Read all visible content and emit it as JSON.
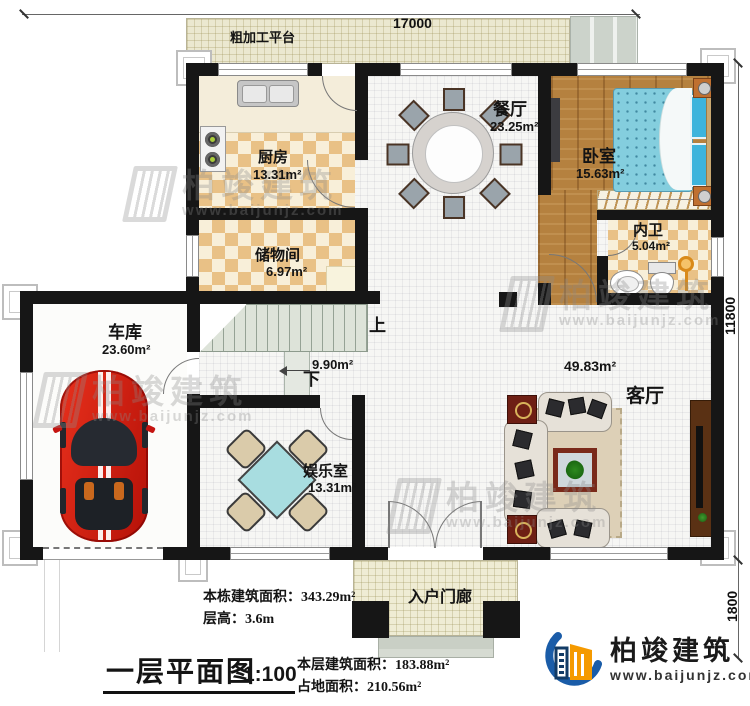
{
  "title": {
    "name": "一层平面图",
    "scale": "1:100"
  },
  "dimensions": {
    "top": "17000",
    "right_upper": "11800",
    "right_lower": "1800"
  },
  "rooms": {
    "platform": {
      "name": "粗加工平台"
    },
    "kitchen": {
      "name": "厨房",
      "area": "13.31m²"
    },
    "storage": {
      "name": "储物间",
      "area": "6.97m²"
    },
    "dining": {
      "name": "餐厅",
      "area": "23.25m²"
    },
    "bedroom": {
      "name": "卧室",
      "area": "15.63m²"
    },
    "bath": {
      "name": "内卫",
      "area": "5.04m²"
    },
    "garage": {
      "name": "车库",
      "area": "23.60m²"
    },
    "entertainment": {
      "name": "娱乐室",
      "area": "13.31m²"
    },
    "living": {
      "name": "客厅",
      "area": "49.83m²"
    },
    "stairs": {
      "up": "上",
      "down": "下",
      "area": "9.90m²"
    },
    "porch": {
      "name": "入户门廊"
    }
  },
  "notes": {
    "building_area": "本栋建筑面积：343.29m²",
    "floor_height": "层高：3.6m",
    "floor_area": "本层建筑面积：183.88m²",
    "footprint": "占地面积：210.56m²"
  },
  "brand": {
    "name": "柏竣建筑",
    "url": "www.baijunjz.com"
  },
  "watermark": {
    "name": "柏竣建筑",
    "url": "www.baijunjz.com"
  },
  "colors": {
    "wall": "#161616",
    "accent_blue": "#1a5ca8",
    "accent_orange": "#f59a00",
    "car_red": "#d42015"
  }
}
